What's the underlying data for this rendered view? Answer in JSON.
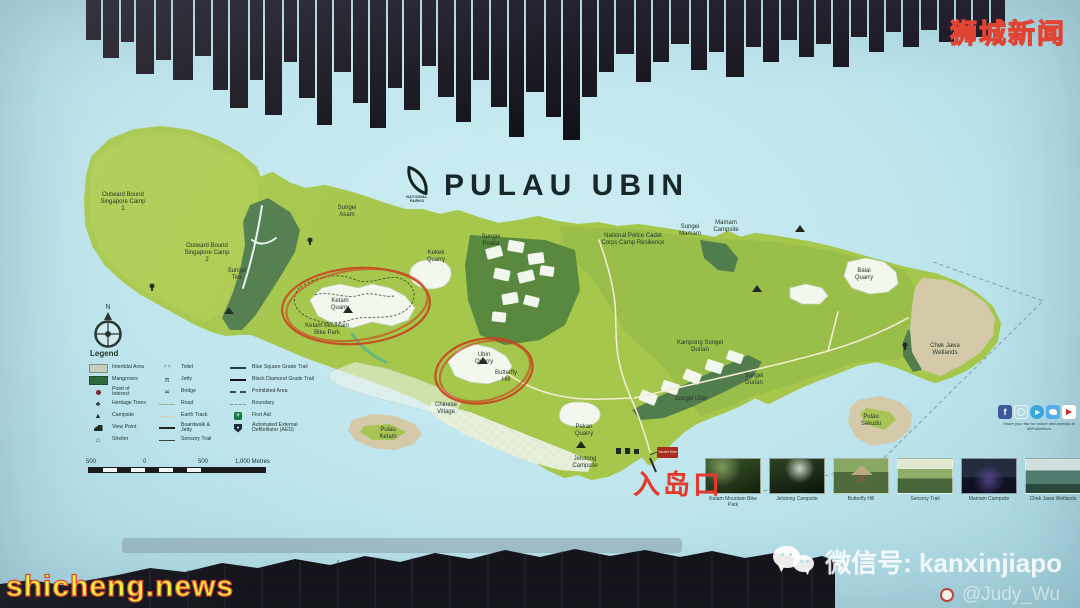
{
  "title": {
    "text": "PULAU UBIN",
    "logo_text": "NATIONAL PARKS"
  },
  "compass": {
    "north": "N"
  },
  "legend": {
    "title": "Legend",
    "col1": [
      "Intertidal Area",
      "Mangroves",
      "Point of Interest",
      "Heritage Trees",
      "Campsite",
      "View Point",
      "Shelter"
    ],
    "col2": [
      "Toilet",
      "Jetty",
      "Bridge",
      "Road",
      "Earth Track",
      "Boardwalk & Jetty",
      "Sensory Trail"
    ],
    "col3": [
      "Blue Square Grade Trail",
      "Black Diamond Grade Trail",
      "Prohibited Area",
      "Boundary",
      "First Aid",
      "Automated External Defibrillator (AED)"
    ]
  },
  "scalebar": {
    "labels": [
      "500",
      "0",
      "500",
      "1,000 Metres"
    ]
  },
  "map_labels": {
    "obs_camp1": "Outward Bound Singapore Camp 1",
    "obs_camp2": "Outward Bound Singapore Camp 2",
    "sungei_tiris": "Sungei Tiris",
    "sungei_asam": "Sungei Asam",
    "sungei_puaka": "Sungei Puaka",
    "kekek_quarry": "Kekek Quarry",
    "ketam_quarry": "Ketam Quarry",
    "ketam_mtb": "Ketam Mountain Bike Park",
    "npcc": "National Police Cadet Corps Camp Resilience",
    "sungei_mamam": "Sungei Mamam",
    "mamam_campsite": "Mamam Campsite",
    "balai_quarry": "Balai Quarry",
    "kampong_sungei_durian": "Kampong Sungei Durian",
    "sungei_durian": "Sungei Durian",
    "sungei_ubin": "Sungei Ubin",
    "chek_jawa": "Chek Jawa Wetlands",
    "ubin_quarry": "Ubin Quarry",
    "butterfly_hill": "Butterfly Hill",
    "chinese_village": "Chinese Village",
    "pekan_quarry": "Pekan Quarry",
    "jelutong_campsite": "Jelutong Campsite",
    "pulau_ketam": "Pulau Ketam",
    "pulau_sekudu": "Pulau Sekudu",
    "you_are_here": "You Are Here"
  },
  "entry_annotation": {
    "text": "入岛口"
  },
  "photos": [
    {
      "caption": "Ketam Mountain Bike Park"
    },
    {
      "caption": "Jelutong Campsite"
    },
    {
      "caption": "Butterfly Hill"
    },
    {
      "caption": "Sensory Trail"
    },
    {
      "caption": "Mamam Campsite"
    },
    {
      "caption": "Chek Jawa Wetlands"
    }
  ],
  "social": {
    "icons": [
      "facebook",
      "instagram",
      "telegram",
      "twitter",
      "youtube"
    ],
    "caption": "Share your trip for nature and animals at #NParksBuzz"
  },
  "watermarks": {
    "top_right": "狮城新闻",
    "bottom_left": "shicheng.news",
    "wechat": "微信号: kanxinjiapo",
    "author": "@Judy_Wu"
  },
  "colors": {
    "water": "#bfe5ec",
    "island_green": "#a5c74b",
    "mangrove_green": "#517c4c",
    "quarry_white": "#f3f8ef",
    "intertidal_tan": "#d4caa9",
    "annotation_red": "#c8441f",
    "entry_text_red": "#e23a2e",
    "watermark_yellow": "#f2ea3e"
  }
}
